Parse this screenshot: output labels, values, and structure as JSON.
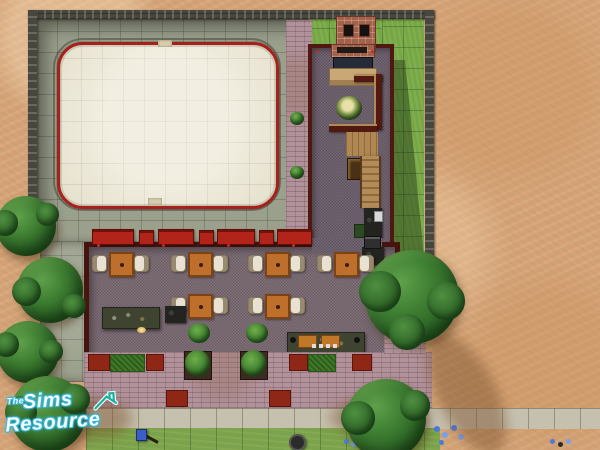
{
  "watermark": {
    "the": "The",
    "sims": "Sims",
    "resource": "Resource",
    "accent_color": "#35b5d8",
    "roof_icon_color": "#1fae9e"
  },
  "palette": {
    "sand": "#d3a276",
    "concrete": "#9ba08d",
    "grass": "#76a746",
    "rink_ice": "#e5dfcb",
    "rink_border": "#a8201a",
    "building_wall": "#511711",
    "wing_floor": "#6b5f6b",
    "dining_floor": "#7a6a73",
    "pavement": "#b1929a",
    "sidewalk": "#c6c0ae",
    "bench_red": "#b2241a",
    "table_wood": "#bd6f2b",
    "stair_wood": "#ae8753"
  },
  "scene_objects": [
    "ice-rink",
    "rink-red-barrier",
    "stone-lot-wall",
    "chimney-fireplace",
    "sofa",
    "indoor-plant",
    "interior-walls",
    "staircase",
    "kitchen-counter",
    "dining-hall",
    "dining-tables",
    "dining-chairs",
    "bar-counter",
    "cash-register",
    "buffet-counter",
    "red-benches",
    "barbecue-grill",
    "planter-shrubs",
    "red-mats",
    "grass-patches",
    "pink-brick-pavement",
    "sidewalk",
    "street-grass",
    "mailbox",
    "trash-can",
    "blue-flowers",
    "trees",
    "sand-terrain",
    "watermark-logo"
  ]
}
